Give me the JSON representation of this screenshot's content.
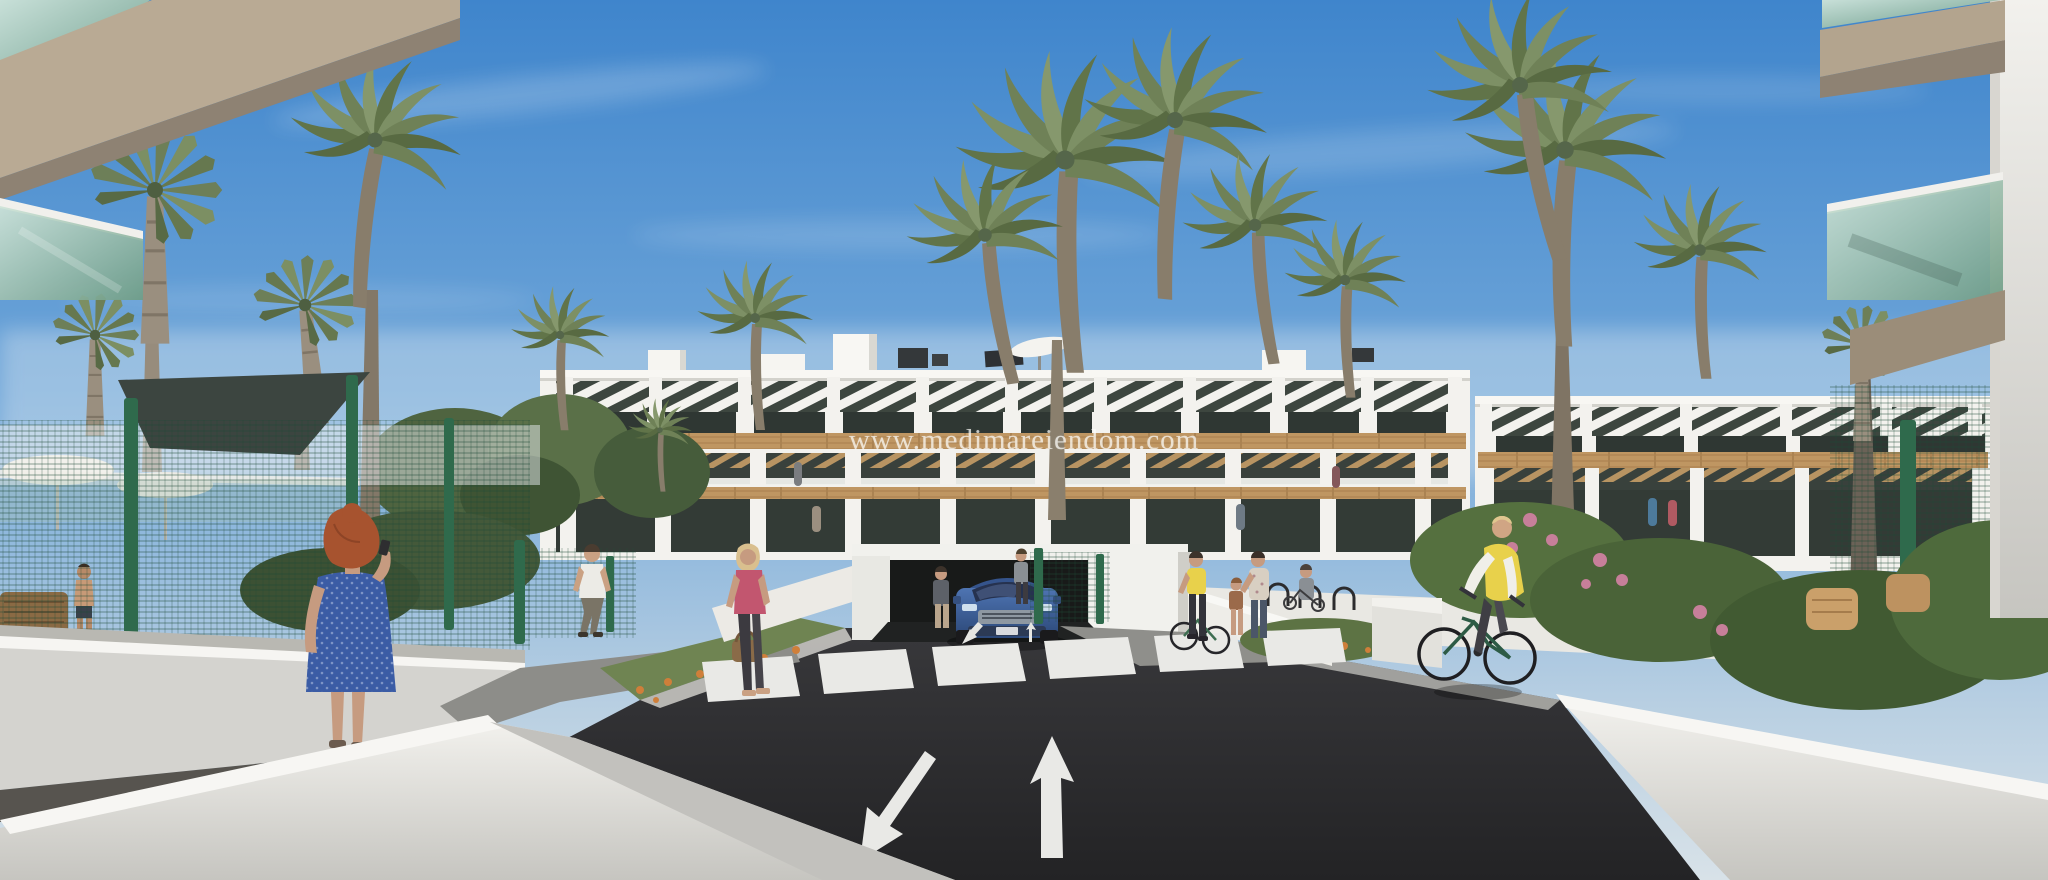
{
  "image": {
    "kind": "3d-architectural-render",
    "subject": "Modern white low-rise apartment complex with palm trees, seen from an access road with a crosswalk, an underground garage exit, pedestrians and a cyclist"
  },
  "watermark": {
    "text": "www.medimareiendom.com"
  },
  "scene": {
    "sky": "blue sky with light wispy clouds",
    "road": {
      "surface": "dark asphalt",
      "markings": [
        "zebra crosswalk",
        "arrow pointing toward viewer",
        "arrow pointing away from viewer",
        "small ramp arrows at garage exit"
      ]
    },
    "vehicles": [
      "blue SUV exiting underground garage"
    ],
    "figures": [
      "woman in blue patterned dress talking on phone",
      "man in white t-shirt walking away",
      "blonde woman in pink top carrying brown handbag",
      "woman standing by garage wall",
      "woman in gray top on footpath",
      "woman in yellow top wheeling a bicycle",
      "child",
      "woman accompanying child",
      "person with stroller",
      "cyclist in yellow vest riding toward viewer",
      "shirtless man in pool area",
      "residents on terraces"
    ],
    "vegetation": [
      "feather palm trees",
      "fan palms",
      "round canopy trees",
      "hedges",
      "orange flower beds",
      "pink flowering shrubs"
    ],
    "structures": [
      "white apartment buildings with wooden accent bands and slatted pergolas",
      "foreground balconies with green glass railings and beige slabs",
      "green wire-mesh security fences",
      "white perimeter and ramp walls",
      "underground garage entrance",
      "pool umbrellas and dark shade sail",
      "bicycle racks",
      "wicker garden furniture"
    ]
  },
  "colors": {
    "sky_top": "#3f85cc",
    "sky_horizon": "#d8e2e8",
    "building_white": "#f3f2ee",
    "loggia_dark": "#3d463f",
    "wood_tan": "#bf9662",
    "palm_green": "#6f8157",
    "trunk_brown": "#887d6b",
    "fence_green": "#2f6a4c",
    "road_asphalt": "#2c2c2e",
    "marking_white": "#e9e9e6",
    "wall_light": "#ecebe7",
    "slab_beige": "#b3a28c",
    "glass_green": "#8fb6a1",
    "car_blue": "#3f69ad",
    "dress_blue": "#3b5ca5",
    "vest_yellow": "#e8d14b",
    "top_pink": "#c2566f",
    "skin": "#c69b80",
    "hair_red": "#a7532f"
  }
}
